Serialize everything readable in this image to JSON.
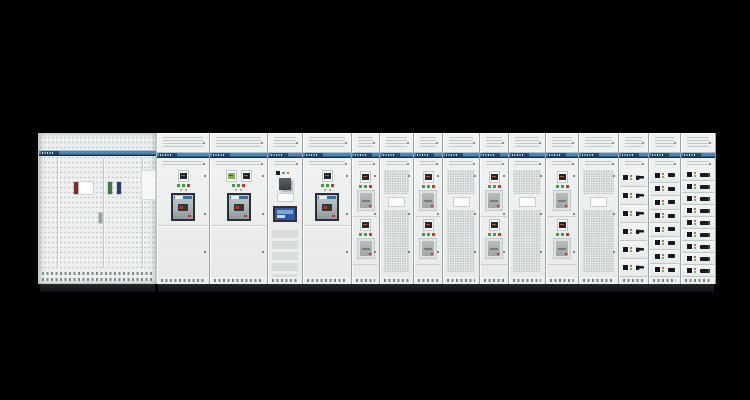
{
  "scene": {
    "description": "Photograph of a low-voltage switchgear / motor control center lineup on a black background",
    "background": "#000000"
  },
  "palette": {
    "panel": "#edf0ef",
    "band_blue": "#4d86aa",
    "band_dark": "#14304b",
    "plinth": "#121517",
    "led": {
      "green": "#3da23c",
      "red": "#c23b2e",
      "yellow": "#d2a93a",
      "white": "#f2f4f3"
    },
    "label": {
      "red": "#7e2a22",
      "white": "#fdfdfd",
      "green": "#3e7a4a",
      "navy": "#2c3d6e"
    },
    "acb_frame": "#2b2f31",
    "hmi_screen": "#2a5cad",
    "handle_black": "#17191b"
  },
  "left_cabinet": {
    "type": "perforated-distribution-cabinet",
    "brand_logo": "illegible-blue-band-logo",
    "door_seams_x": [
      19,
      65,
      104
    ],
    "door_labels": [
      {
        "color": "red",
        "x": 36,
        "w": 4
      },
      {
        "color": "white",
        "x": 41,
        "w": 14
      },
      {
        "color": "green",
        "x": 70,
        "w": 4
      },
      {
        "color": "navy",
        "x": 79,
        "w": 4
      }
    ]
  },
  "lineup": {
    "brand_logo": "illegible-blue-band-logo",
    "sections": [
      {
        "id": "acb-1",
        "type": "acb",
        "width": 53,
        "meters": [
          "dark"
        ],
        "leds": [
          "green",
          "green",
          "red"
        ]
      },
      {
        "id": "acb-2",
        "type": "acb",
        "width": 58,
        "meters": [
          "green",
          "dark"
        ],
        "leds": [
          "green",
          "green",
          "red"
        ]
      },
      {
        "id": "hmi",
        "type": "hmi",
        "width": 35,
        "leds": [
          "green",
          "red",
          "white"
        ]
      },
      {
        "id": "acb-3",
        "type": "acb",
        "width": 49,
        "meters": [
          "dark"
        ],
        "leds": [
          "green",
          "green",
          "red"
        ]
      },
      {
        "id": "feeder-1",
        "type": "feeder",
        "width": 28,
        "tiers": 2,
        "leds": [
          "green",
          "green",
          "red"
        ]
      },
      {
        "id": "mesh-1",
        "type": "mesh",
        "width": 34
      },
      {
        "id": "feeder-2",
        "type": "feeder",
        "width": 29,
        "tiers": 2,
        "leds": [
          "green",
          "green",
          "red"
        ]
      },
      {
        "id": "mesh-2",
        "type": "mesh",
        "width": 37
      },
      {
        "id": "feeder-3",
        "type": "feeder",
        "width": 29,
        "tiers": 2,
        "leds": [
          "green",
          "green",
          "red"
        ]
      },
      {
        "id": "mesh-3",
        "type": "mesh",
        "width": 37
      },
      {
        "id": "feeder-4",
        "type": "feeder",
        "width": 33,
        "tiers": 2,
        "leds": [
          "green",
          "green",
          "red"
        ]
      },
      {
        "id": "mesh-4",
        "type": "mesh",
        "width": 40
      },
      {
        "id": "drawers-1",
        "type": "drawers",
        "width": 30,
        "rows": 6,
        "handle": "pistol"
      },
      {
        "id": "drawers-2",
        "type": "drawers",
        "width": 32,
        "rows": 8,
        "handle": "knob"
      },
      {
        "id": "drawers-3",
        "type": "drawers",
        "width": 35,
        "rows": 9,
        "handle": "bar"
      }
    ]
  }
}
